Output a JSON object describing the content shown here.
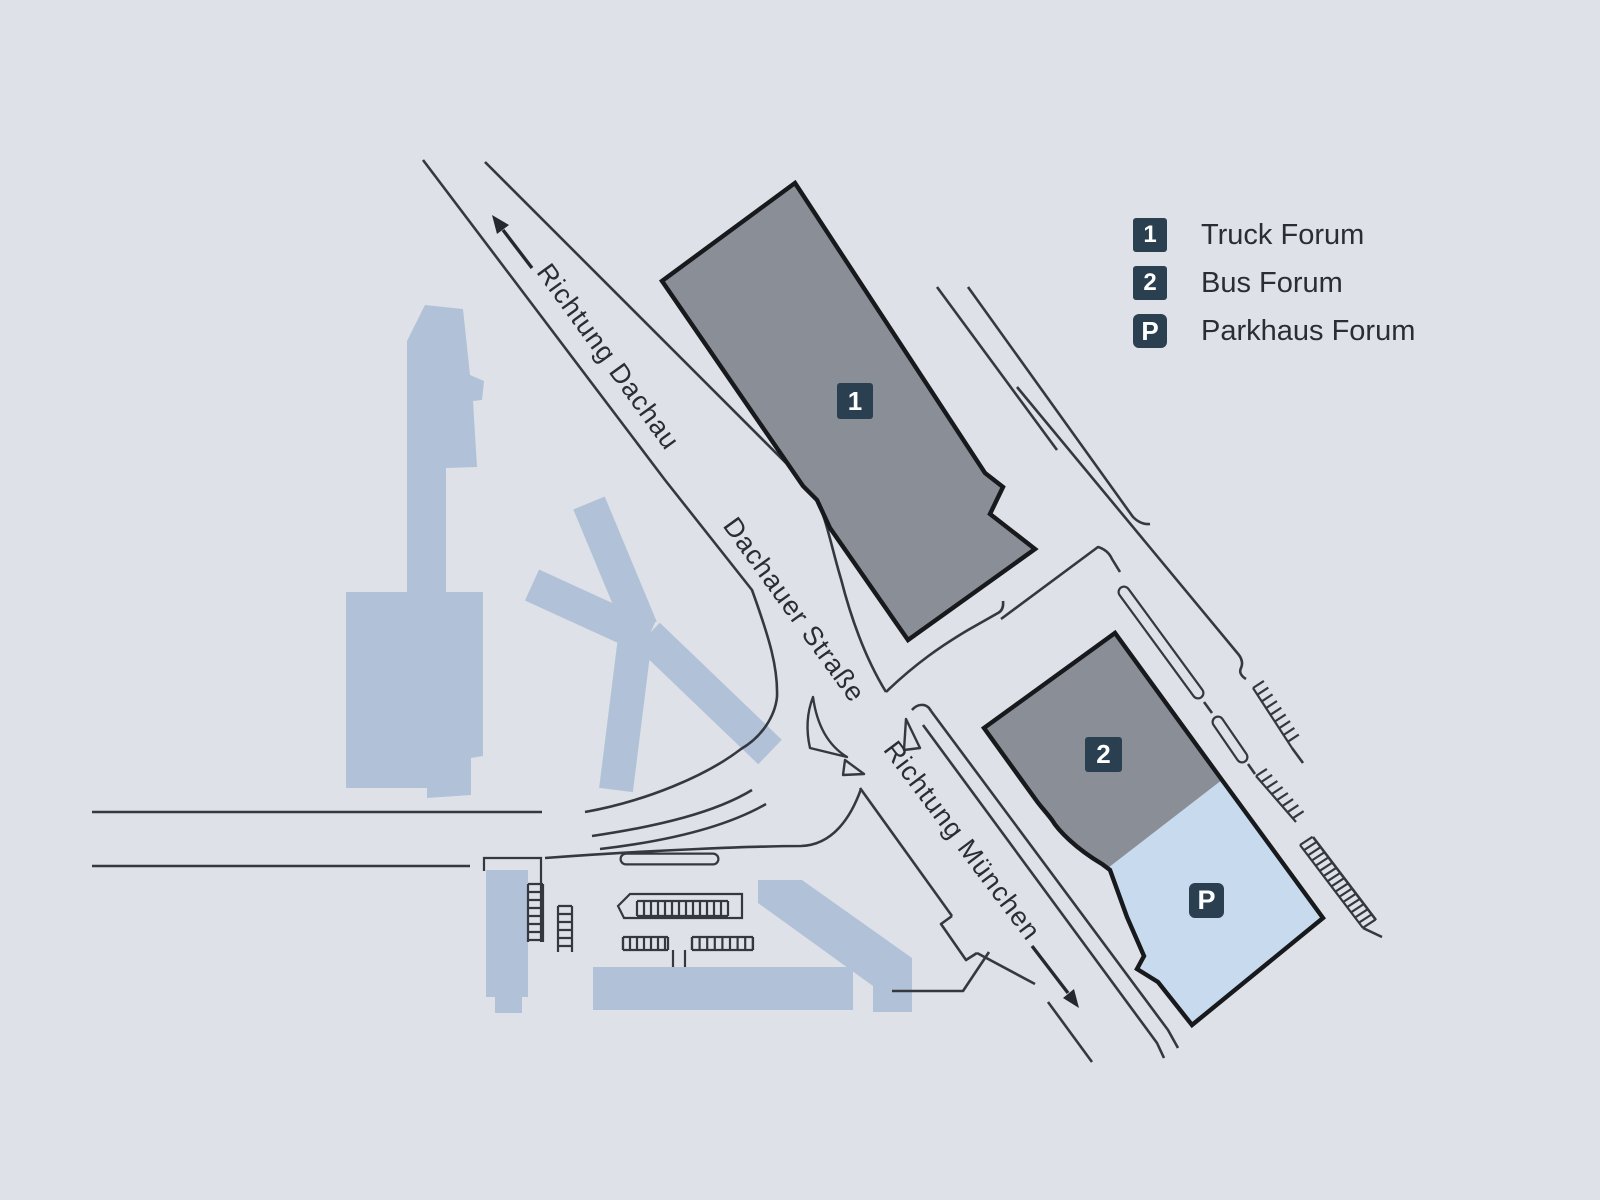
{
  "colors": {
    "background": "#dee1e7",
    "silhouette_blue": "#b1c2d8",
    "parkhaus_blue": "#c8dbee",
    "building_gray": "#8a8e96",
    "building_outline": "#17191c",
    "road_line": "#35393f",
    "badge_navy": "#2a4051",
    "text_dark": "#2a2d31"
  },
  "legend": {
    "items": [
      {
        "badge": "1",
        "label": "Truck Forum"
      },
      {
        "badge": "2",
        "label": "Bus Forum"
      },
      {
        "badge": "P",
        "label": "Parkhaus Forum"
      }
    ]
  },
  "map": {
    "streets": [
      {
        "name": "Richtung Dachau",
        "icon": "arrow-up-left-icon"
      },
      {
        "name": "Dachauer Straße"
      },
      {
        "name": "Richtung München",
        "icon": "arrow-down-right-icon"
      }
    ],
    "markers": [
      {
        "badge": "1"
      },
      {
        "badge": "2"
      },
      {
        "badge": "P"
      }
    ]
  }
}
